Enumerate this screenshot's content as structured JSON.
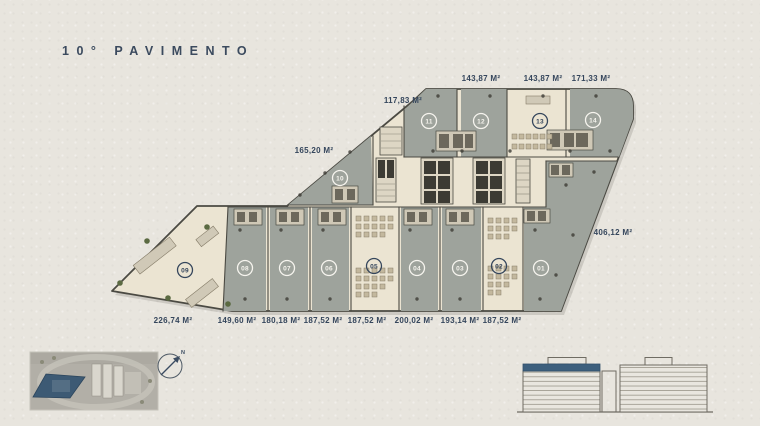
{
  "title": "10° PAVIMENTO",
  "floor_plan": {
    "units": [
      {
        "id": "01",
        "area": "406,12 M²",
        "furnished": false
      },
      {
        "id": "02",
        "area": "187,52 M²",
        "furnished": true
      },
      {
        "id": "03",
        "area": "193,14 M²",
        "furnished": false
      },
      {
        "id": "04",
        "area": "200,02 M²",
        "furnished": false
      },
      {
        "id": "05",
        "area": "187,52 M²",
        "furnished": true
      },
      {
        "id": "06",
        "area": "187,52 M²",
        "furnished": false
      },
      {
        "id": "07",
        "area": "180,18 M²",
        "furnished": false
      },
      {
        "id": "08",
        "area": "149,60 M²",
        "furnished": false
      },
      {
        "id": "09",
        "area": "226,74 M²",
        "furnished": true
      },
      {
        "id": "10",
        "area": "165,20 M²",
        "furnished": false
      },
      {
        "id": "11",
        "area": "117,83 M²",
        "furnished": false
      },
      {
        "id": "12",
        "area": "143,87 M²",
        "furnished": false
      },
      {
        "id": "13",
        "area": "143,87 M²",
        "furnished": true
      },
      {
        "id": "14",
        "area": "171,33 M²",
        "furnished": false
      }
    ]
  },
  "compass": {
    "north_label": "N"
  },
  "colors": {
    "background": "#e8e5de",
    "navy_text": "#35465c",
    "unit_gray": "#9ea39c",
    "unit_beige": "#ebe4d2",
    "wall": "#4b4a43",
    "floor_highlight": "#3d5f7d",
    "site_footprint_blue": "#3d5a74"
  }
}
